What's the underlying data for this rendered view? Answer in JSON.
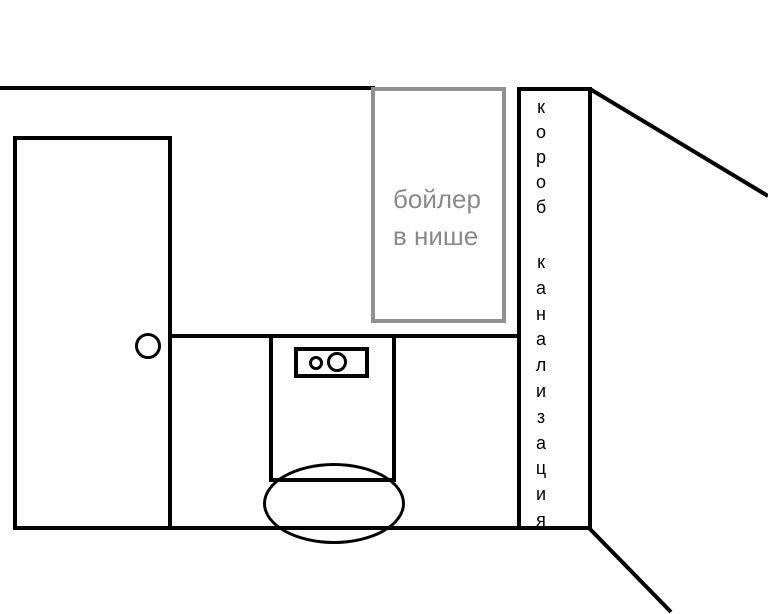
{
  "sketch": {
    "type": "bathroom-plan-hand-drawing",
    "labels": {
      "boiler_niche": {
        "line1": "бойлер",
        "line2": "в нише"
      },
      "sewer_duct": {
        "word1": "короб",
        "word2": "канализация"
      }
    },
    "colors": {
      "wall_line": "#000000",
      "niche_outline": "#909090",
      "niche_text": "#8a8a8a",
      "background": "#ffffff"
    }
  }
}
